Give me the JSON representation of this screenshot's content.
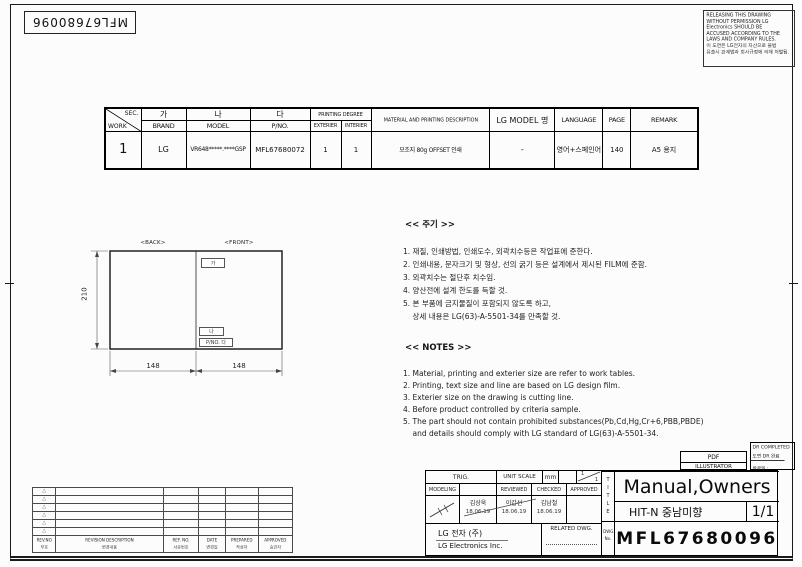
{
  "page": {
    "doc_no_top": "MFL67680096"
  },
  "warning_box": {
    "en1": "RELEASING THIS DRAWING",
    "en2": "WITHOUT PERMISSION LG",
    "en3": "Electronics SHOULD BE",
    "en4": "ACCUSED ACCORDING TO THE",
    "en5": "LAWS AND COMPANY RULES.",
    "ko1": "이 도면은 LG전자의 자산으로 불법",
    "ko2": "유출시 관계법과 회사규정에 의해 처벌됨."
  },
  "work_table": {
    "h_sec": "SEC.",
    "h_work": "WORK",
    "h_ga": "가",
    "h_brand": "BRAND",
    "h_na": "나",
    "h_model": "MODEL",
    "h_da": "다",
    "h_pno": "P/NO.",
    "h_printing": "PRINTING DEGREE",
    "h_ext": "EXTERIER",
    "h_int": "INTERIER",
    "h_material": "MATERIAL AND PRINTING DESCRIPTION",
    "h_lg_model": "LG MODEL 명",
    "h_language": "LANGUAGE",
    "h_page": "PAGE",
    "h_remark": "REMARK",
    "row": {
      "sec": "1",
      "brand": "LG",
      "model": "VR648*****.****GSP",
      "pno": "MFL67680072",
      "ext": "1",
      "int": "1",
      "material": "모조지 80g OFFSET 인쇄",
      "lg_model": "-",
      "language": "영어+스페인어",
      "page": "140",
      "remark": "A5 용지"
    }
  },
  "drawing": {
    "back_label": "<BACK>",
    "front_label": "<FRONT>",
    "dim_height": "210",
    "dim_left": "148",
    "dim_right": "148",
    "box_brand": "가",
    "box_model": "나",
    "box_pno": "P/NO. 다"
  },
  "notes_ko": {
    "title": "<< 주기 >>",
    "lines": [
      "1. 재질, 인쇄방법, 인쇄도수, 외곽치수등은 작업표에 준한다.",
      "2. 인쇄내용, 문자크기 및 형상, 선의 굵기 등은 설계에서 제시된 FILM에 준함.",
      "3. 외곽치수는 절단후 치수임.",
      "4. 양산전에 설계 한도를 득할 것.",
      "5. 본 부품에 금지물질이 포함되지 않도록 하고,",
      "    상세 내용은 LG(63)-A-5501-34를 만족할 것."
    ]
  },
  "notes_en": {
    "title": "<< NOTES >>",
    "lines": [
      "1. Material, printing and exterier size are refer to work tables.",
      "2. Printing, text size and line are based on LG design film.",
      "3. Exterier size on the drawing is cutting line.",
      "4. Before product controlled by criteria sample.",
      "5. The part should not contain prohibited substances(Pb,Cd,Hg,Cr+6,PBB,PBDE)",
      "    and details should comply with LG standard of LG(63)-A-5501-34."
    ]
  },
  "revision_table": {
    "marker": "△",
    "f_revno": "REV.NO",
    "f_revno_ko": "부호",
    "f_desc": "REVISION DESCRIPTION",
    "f_desc_ko": "변경내용",
    "f_ref": "REF. NO.",
    "f_ref_ko": "사유번호",
    "f_date": "DATE",
    "f_date_ko": "변경일",
    "f_prepared": "PREPARED",
    "f_prepared_ko": "작성자",
    "f_approved": "APPROVED",
    "f_approved_ko": "승인자"
  },
  "title_block": {
    "trig": "TRIG.",
    "modeling": "MODELING",
    "unit_scale": "UNIT SCALE",
    "unit_value": "mm",
    "scale_top": "1",
    "scale_bottom": "1",
    "reviewed": "REVIEWED",
    "checked": "CHECKED",
    "approved": "APPROVED",
    "approvers": [
      {
        "name": "김상욱",
        "date": "18.06.19"
      },
      {
        "name": "이갑선",
        "date": "18.06.19"
      },
      {
        "name": "김남철",
        "date": "18.06.19"
      }
    ],
    "company_ko": "LG 전자  (주)",
    "company_en": "LG Electronics Inc.",
    "related_dwg": "RELATED DWG.",
    "title_vertical": "TITLE",
    "dwg_label_1": "DWG.",
    "dwg_label_2": "No.",
    "title": "Manual,Owners",
    "subtitle": "HIT-N 중남미향",
    "sheet_no": "1/1",
    "dwg_no": "MFL67680096",
    "pdf": "PDF",
    "illustrator": "ILLUSTRATOR",
    "dr_completed_en": "DR COMPLETED",
    "dr_completed_ko": "도면 DR 완료",
    "dr_date_label": "완료일 :"
  }
}
